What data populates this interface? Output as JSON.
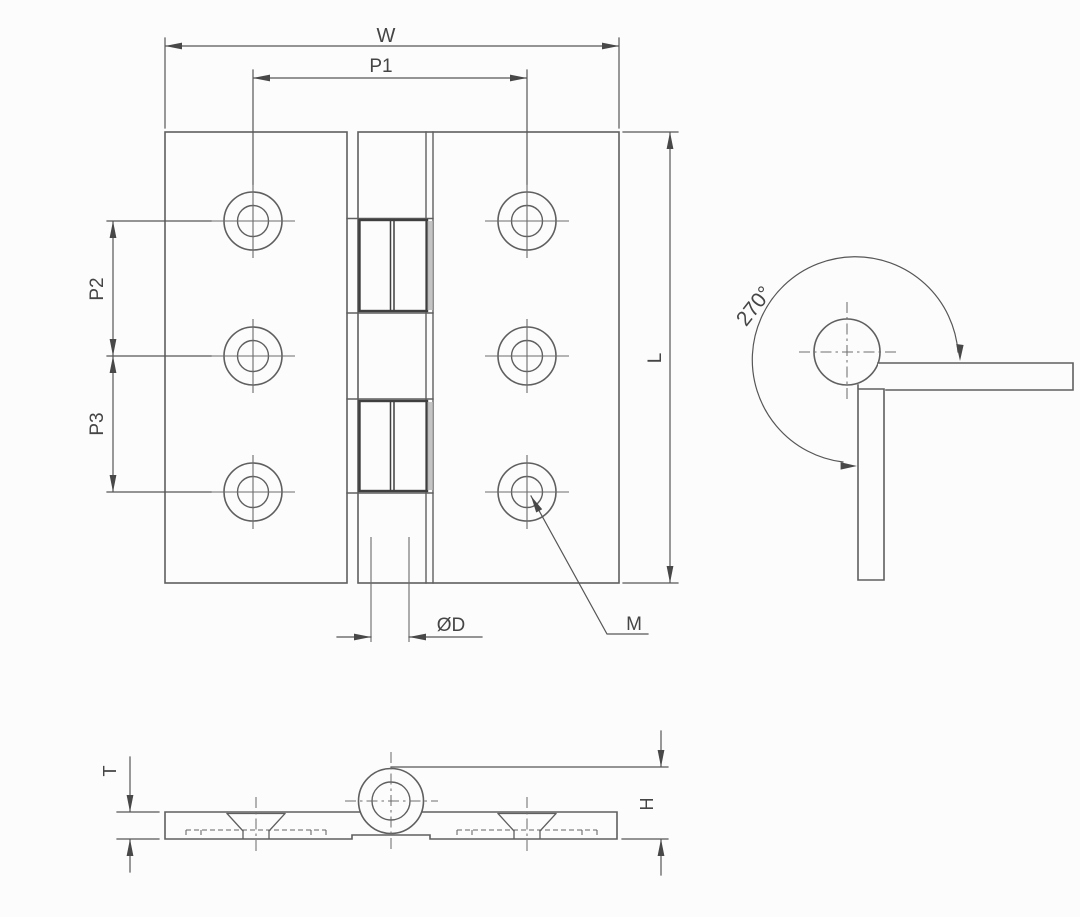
{
  "labels": {
    "width": "W",
    "hole_pitch_width": "P1",
    "hole_pitch_upper": "P2",
    "hole_pitch_lower": "P3",
    "length": "L",
    "pin_diameter": "ØD",
    "mounting_hole": "M",
    "opening_angle": "270°",
    "leaf_thickness": "T",
    "knuckle_height": "H"
  },
  "colors": {
    "background": "#fcfcfc",
    "line": "#5f5f5f",
    "line_dark": "#3f3f3f",
    "dimension": "#565656",
    "text": "#454545",
    "knuckle_shading": "#b5b5b5"
  }
}
